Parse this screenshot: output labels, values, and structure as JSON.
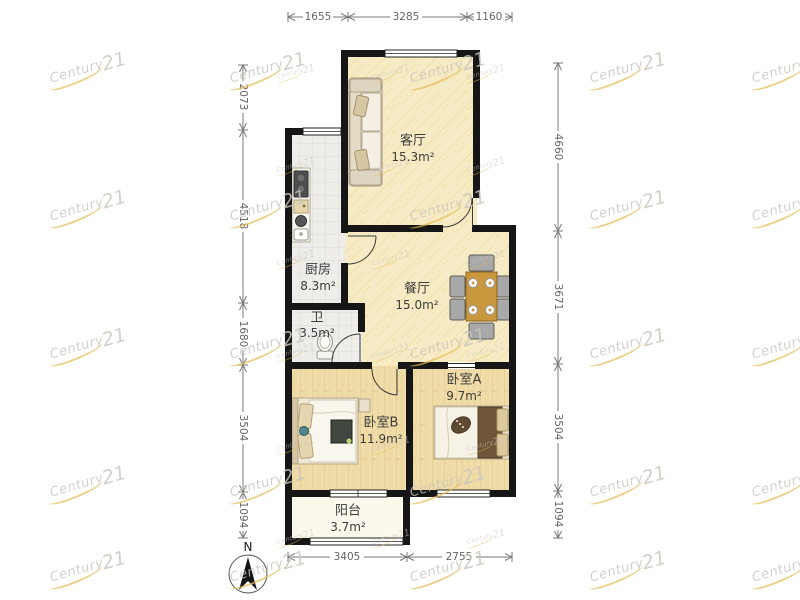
{
  "watermark": {
    "text_main": "Century",
    "text_num": "21"
  },
  "compass": {
    "label": "N"
  },
  "rooms": {
    "living": {
      "name": "客厅",
      "area": "15.3m²"
    },
    "kitchen": {
      "name": "厨房",
      "area": "8.3m²"
    },
    "dining": {
      "name": "餐厅",
      "area": "15.0m²"
    },
    "bath": {
      "name": "卫",
      "area": "3.5m²"
    },
    "bedroom_a": {
      "name": "卧室A",
      "area": "9.7m²"
    },
    "bedroom_b": {
      "name": "卧室B",
      "area": "11.9m²"
    },
    "balcony": {
      "name": "阳台",
      "area": "3.7m²"
    }
  },
  "dimensions": {
    "top": [
      "1655",
      "3285",
      "1160"
    ],
    "bottom": [
      "3405",
      "2755"
    ],
    "left": [
      "2073",
      "4518",
      "1680",
      "3504",
      "1094"
    ],
    "right": [
      "4660",
      "3671",
      "3504",
      "1094"
    ]
  },
  "colors": {
    "wall": "#161616",
    "floor_living_dining": "#f6ebc5",
    "floor_tile": "#eeedea",
    "floor_wood": "#f0dca8",
    "floor_balcony": "#fbf8ec",
    "watermark_gray": "#c9c5be",
    "watermark_gold": "#e3bd55"
  }
}
